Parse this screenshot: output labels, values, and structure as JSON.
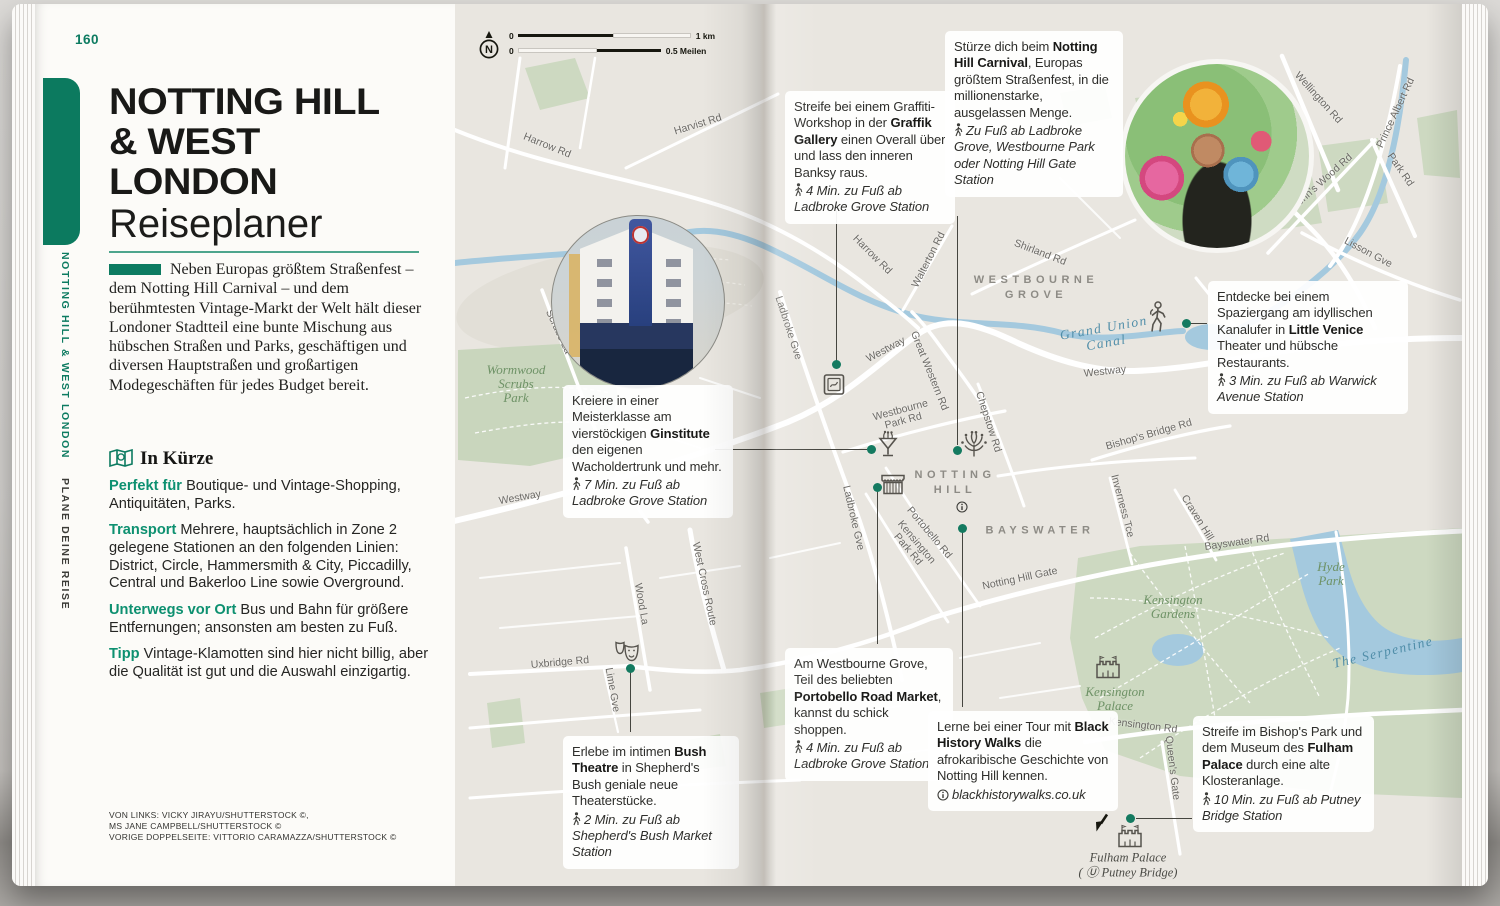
{
  "colors": {
    "accent": "#0d7b61",
    "paper": "#fcfbf8",
    "map_bg": "#e9e6e0",
    "park_green": "#cdd9c1",
    "water_blue": "#a4c9de",
    "marker_teal": "#147a60"
  },
  "left_page": {
    "page_number": "160",
    "sidebar": {
      "primary": "NOTTING HILL & WEST LONDON",
      "secondary": "PLANE DEINE REISE"
    },
    "title_lines": [
      "NOTTING HILL",
      "& WEST",
      "LONDON"
    ],
    "subtitle": "Reiseplaner",
    "intro": "Neben Europas größtem Straßenfest – dem Notting Hill Carnival – und dem berühmtesten Vintage-Markt der Welt hält dieser Londoner Stadtteil eine bunte Mischung aus hübschen Straßen und Parks, geschäftigen und diversen Hauptstraßen und großartigen Modegeschäften für jedes Budget bereit.",
    "in_kuerze": {
      "heading": "In Kürze",
      "items": [
        {
          "label": "Perfekt für",
          "text": "Boutique- und Vintage-Shopping, Antiquitäten, Parks."
        },
        {
          "label": "Transport",
          "text": "Mehrere, hauptsächlich in Zone 2 gelegene Stationen an den folgenden Linien: District, Circle, Hammersmith & City, Piccadilly, Central und Bakerloo Line sowie Overground."
        },
        {
          "label": "Unterwegs vor Ort",
          "text": "Bus und Bahn für größere Entfernungen; ansonsten am besten zu Fuß."
        },
        {
          "label": "Tipp",
          "text": "Vintage-Klamotten sind hier nicht billig, aber die Qualität ist gut und die Auswahl einzigartig."
        }
      ]
    },
    "credits": [
      "VON LINKS: VICKY JIRAYU/SHUTTERSTOCK ©,",
      "MS JANE CAMPBELL/SHUTTERSTOCK ©",
      "VORIGE DOPPELSEITE: VITTORIO CARAMAZZA/SHUTTERSTOCK ©"
    ]
  },
  "map": {
    "scale": {
      "north": "N",
      "zero_km": "0",
      "zero_mi": "0",
      "km": "1 km",
      "miles": "0.5 Meilen"
    },
    "area_labels": [
      {
        "lines": [
          "WESTBOURNE",
          "GROVE"
        ],
        "x": 581,
        "y": 284
      },
      {
        "lines": [
          "MAIDA",
          "VALE"
        ],
        "x": 787,
        "y": 225
      },
      {
        "lines": [
          "NOTTING",
          "HILL"
        ],
        "x": 500,
        "y": 479
      },
      {
        "lines": [
          "BAYSWATER"
        ],
        "x": 585,
        "y": 527
      }
    ],
    "park_labels": [
      {
        "lines": [
          "Wormwood",
          "Scrubs",
          "Park"
        ],
        "x": 61,
        "y": 380
      },
      {
        "lines": [
          "Kensington",
          "Gardens"
        ],
        "x": 718,
        "y": 603
      },
      {
        "lines": [
          "Hyde",
          "Park"
        ],
        "x": 876,
        "y": 570
      },
      {
        "lines": [
          "Kensington",
          "Palace"
        ],
        "x": 660,
        "y": 695
      }
    ],
    "water_labels": [
      {
        "lines": [
          "Grand Union",
          "Canal"
        ],
        "x": 650,
        "y": 331,
        "r": -10
      },
      {
        "lines": [
          "The Serpentine"
        ],
        "x": 928,
        "y": 648,
        "r": -13
      }
    ],
    "poi_labels": [
      {
        "lines": [
          "Fulham Palace",
          "( Ⓤ Putney Bridge)"
        ],
        "x": 673,
        "y": 861
      }
    ],
    "street_labels": [
      {
        "t": "Harrow Rd",
        "x": 92,
        "y": 142,
        "r": 22
      },
      {
        "t": "Harvist Rd",
        "x": 243,
        "y": 121,
        "r": -17
      },
      {
        "t": "Harrow Rd",
        "x": 417,
        "y": 251,
        "r": 45
      },
      {
        "t": "Walterton Rd",
        "x": 474,
        "y": 256,
        "r": -63
      },
      {
        "t": "Shirland Rd",
        "x": 585,
        "y": 249,
        "r": 21
      },
      {
        "t": "Wellington Rd",
        "x": 863,
        "y": 94,
        "r": 48
      },
      {
        "t": "Prince Albert Rd",
        "x": 941,
        "y": 109,
        "r": -65
      },
      {
        "t": "St John's Wood Rd",
        "x": 863,
        "y": 182,
        "r": -42
      },
      {
        "t": "Park Rd",
        "x": 945,
        "y": 166,
        "r": 55
      },
      {
        "t": "Lisson Gve",
        "x": 913,
        "y": 249,
        "r": 28
      },
      {
        "t": "Westway",
        "x": 65,
        "y": 494,
        "r": -10
      },
      {
        "t": "Westway",
        "x": 431,
        "y": 346,
        "r": -28
      },
      {
        "t": "Westway",
        "x": 650,
        "y": 368,
        "r": -6
      },
      {
        "t": "Great Western Rd",
        "x": 474,
        "y": 367,
        "r": 68
      },
      {
        "t": "Ladbroke Gve",
        "x": 333,
        "y": 324,
        "r": 72
      },
      {
        "t": "Ladbroke Gve",
        "x": 398,
        "y": 514,
        "r": 77
      },
      {
        "lines": [
          "Westbourne",
          "Park Rd"
        ],
        "x": 447,
        "y": 412,
        "r": -15
      },
      {
        "t": "Chepstow Rd",
        "x": 533,
        "y": 418,
        "r": 72
      },
      {
        "t": "Portobello Rd",
        "x": 474,
        "y": 529,
        "r": 50
      },
      {
        "lines": [
          "Kensington",
          "Park Rd"
        ],
        "x": 457,
        "y": 542,
        "r": 50
      },
      {
        "t": "Notting Hill Gate",
        "x": 565,
        "y": 575,
        "r": -12
      },
      {
        "t": "Bayswater Rd",
        "x": 782,
        "y": 539,
        "r": -8
      },
      {
        "t": "Inverness Tce",
        "x": 667,
        "y": 502,
        "r": 75
      },
      {
        "t": "Craven Hill",
        "x": 742,
        "y": 514,
        "r": 58
      },
      {
        "t": "Bishop's Bridge Rd",
        "x": 694,
        "y": 431,
        "r": -16
      },
      {
        "t": "Kensington Rd",
        "x": 688,
        "y": 722,
        "r": 7
      },
      {
        "t": "Queen's Gate",
        "x": 717,
        "y": 764,
        "r": 83
      },
      {
        "t": "Wood La",
        "x": 186,
        "y": 600,
        "r": 80
      },
      {
        "t": "West Cross Route",
        "x": 249,
        "y": 580,
        "r": 78
      },
      {
        "t": "Scrubs La",
        "x": 103,
        "y": 328,
        "r": 65
      },
      {
        "t": "Uxbridge Rd",
        "x": 105,
        "y": 659,
        "r": -5
      },
      {
        "t": "Lime Gve",
        "x": 157,
        "y": 686,
        "r": 80
      }
    ],
    "icons": [
      {
        "k": "frame",
        "name": "graffiti-gallery-icon",
        "x": 379,
        "y": 383
      },
      {
        "k": "cocktail",
        "name": "gin-distillery-icon",
        "x": 433,
        "y": 443
      },
      {
        "k": "market",
        "name": "market-stall-icon",
        "x": 438,
        "y": 482
      },
      {
        "k": "fireworks",
        "name": "carnival-icon",
        "x": 519,
        "y": 444
      },
      {
        "k": "info",
        "name": "visitor-info-icon",
        "x": 507,
        "y": 505
      },
      {
        "k": "walker",
        "name": "walking-person-icon",
        "x": 702,
        "y": 316
      },
      {
        "k": "masks",
        "name": "theatre-masks-icon",
        "x": 172,
        "y": 651
      },
      {
        "k": "castle",
        "name": "fulham-palace-icon",
        "x": 675,
        "y": 833
      },
      {
        "k": "castle",
        "name": "kensington-palace-icon",
        "x": 653,
        "y": 664
      },
      {
        "k": "arrow",
        "name": "offmap-arrow-icon",
        "x": 647,
        "y": 822
      }
    ],
    "markers": [
      {
        "x": 381,
        "y": 360
      },
      {
        "x": 502,
        "y": 446
      },
      {
        "x": 731,
        "y": 319
      },
      {
        "x": 416,
        "y": 445
      },
      {
        "x": 422,
        "y": 483
      },
      {
        "x": 507,
        "y": 524
      },
      {
        "x": 675,
        "y": 814
      },
      {
        "x": 175,
        "y": 664
      }
    ],
    "connectors": [
      {
        "x1": 381,
        "y1": 207,
        "x2": 381,
        "y2": 357
      },
      {
        "x1": 502,
        "y1": 212,
        "x2": 502,
        "y2": 441
      },
      {
        "x1": 733,
        "y1": 319,
        "x2": 752,
        "y2": 319
      },
      {
        "x1": 260,
        "y1": 445,
        "x2": 412,
        "y2": 445
      },
      {
        "x1": 422,
        "y1": 487,
        "x2": 422,
        "y2": 640
      },
      {
        "x1": 507,
        "y1": 528,
        "x2": 507,
        "y2": 703
      },
      {
        "x1": 681,
        "y1": 814,
        "x2": 737,
        "y2": 814
      },
      {
        "x1": 175,
        "y1": 662,
        "x2": 175,
        "y2": 728
      }
    ],
    "callouts": [
      {
        "id": "graffik-gallery",
        "x": 330,
        "y": 87,
        "w": 152,
        "parts": [
          {
            "t": "Streife bei einem Graffiti-Workshop in der "
          },
          {
            "t": "Graffik Gallery",
            "b": true
          },
          {
            "t": " einen Overall über und lass den inneren Banksy raus."
          }
        ],
        "meta": {
          "icon": "walk",
          "text": "4 Min. zu Fuß ab Ladbroke Grove Station"
        }
      },
      {
        "id": "notting-hill-carnival",
        "x": 490,
        "y": 27,
        "w": 160,
        "parts": [
          {
            "t": "Stürze dich beim "
          },
          {
            "t": "Notting Hill Carnival",
            "b": true
          },
          {
            "t": ", Europas größtem Straßenfest, in die millionenstarke, ausgelassen Menge."
          }
        ],
        "meta": {
          "icon": "walk",
          "text": "Zu Fuß ab Ladbroke Grove, Westbourne Park oder Notting Hill Gate Station"
        }
      },
      {
        "id": "little-venice",
        "x": 753,
        "y": 277,
        "w": 182,
        "parts": [
          {
            "t": "Entdecke bei einem Spaziergang am idyllischen Kanalufer in "
          },
          {
            "t": "Little Venice",
            "b": true
          },
          {
            "t": " Theater und hübsche Restaurants."
          }
        ],
        "meta": {
          "icon": "walk",
          "text": "3 Min. zu Fuß ab Warwick Avenue Station"
        }
      },
      {
        "id": "ginstitute",
        "x": 108,
        "y": 381,
        "w": 152,
        "parts": [
          {
            "t": "Kreiere in einer Meisterklasse am vierstöckigen "
          },
          {
            "t": "Ginstitute",
            "b": true
          },
          {
            "t": " den eigenen Wacholdertrunk und mehr."
          }
        ],
        "meta": {
          "icon": "walk",
          "text": "7 Min. zu Fuß ab Ladbroke Grove Station"
        }
      },
      {
        "id": "portobello-road-market",
        "x": 330,
        "y": 644,
        "w": 150,
        "parts": [
          {
            "t": "Am Westbourne Grove, Teil des beliebten "
          },
          {
            "t": "Portobello Road Market",
            "b": true
          },
          {
            "t": ", kannst du schick shoppen."
          }
        ],
        "meta": {
          "icon": "walk",
          "text": "4 Min. zu Fuß ab Ladbroke Grove Station"
        }
      },
      {
        "id": "black-history-walks",
        "x": 473,
        "y": 707,
        "w": 172,
        "parts": [
          {
            "t": "Lerne bei einer Tour mit "
          },
          {
            "t": "Black History Walks",
            "b": true
          },
          {
            "t": " die afrokaribische Geschichte von Notting Hill kennen."
          }
        ],
        "meta": {
          "icon": "info",
          "text": "blackhistorywalks.co.uk"
        }
      },
      {
        "id": "fulham-palace",
        "x": 738,
        "y": 712,
        "w": 163,
        "parts": [
          {
            "t": "Streife im Bishop's Park und dem Museum des "
          },
          {
            "t": "Fulham Palace",
            "b": true
          },
          {
            "t": " durch eine alte Klosteranlage."
          }
        ],
        "meta": {
          "icon": "walk",
          "text": "10 Min. zu Fuß ab Putney Bridge Station"
        }
      },
      {
        "id": "bush-theatre",
        "x": 108,
        "y": 732,
        "w": 158,
        "parts": [
          {
            "t": "Erlebe im intimen "
          },
          {
            "t": "Bush Theatre",
            "b": true
          },
          {
            "t": " in Shepherd's Bush geniale neue Theaterstücke."
          }
        ],
        "meta": {
          "icon": "walk",
          "text": "2 Min. zu Fuß ab Shepherd's Bush Market Station"
        }
      }
    ]
  }
}
